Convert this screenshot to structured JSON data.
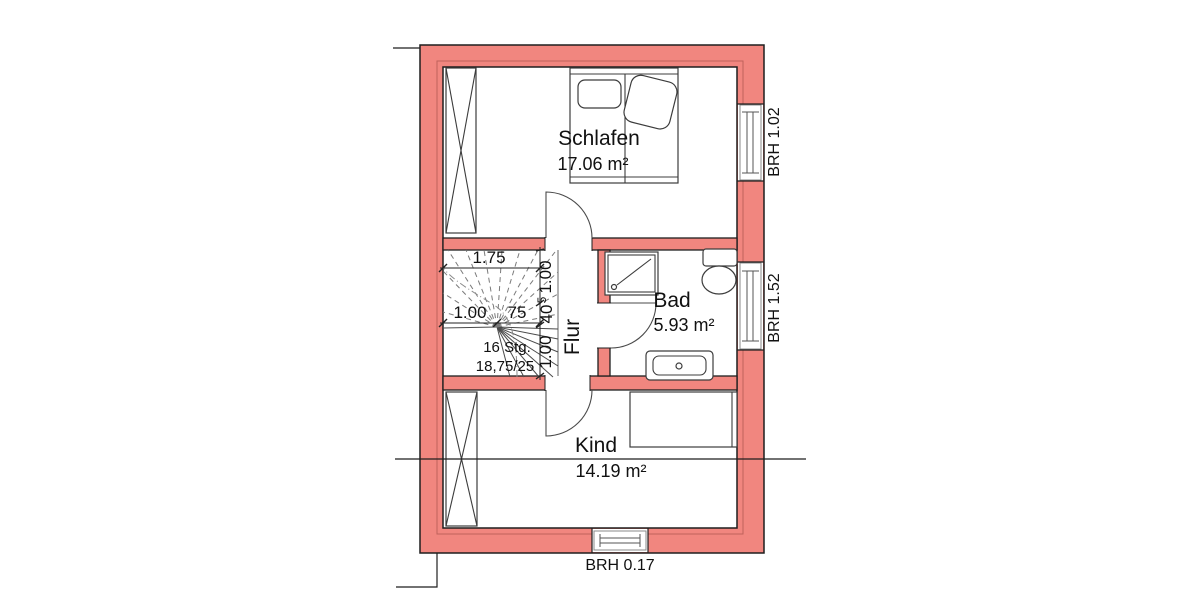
{
  "rooms": {
    "schlafen": {
      "name": "Schlafen",
      "area": "17.06 m²"
    },
    "bad": {
      "name": "Bad",
      "area": "5.93 m²"
    },
    "kind": {
      "name": "Kind",
      "area": "14.19 m²"
    },
    "flur": {
      "name": "Flur"
    }
  },
  "windows": {
    "schlafen_window": {
      "label": "BRH 1.02"
    },
    "bad_window": {
      "label": "BRH 1.52"
    },
    "kind_window": {
      "label": "BRH 0.17"
    }
  },
  "stairs": {
    "steps_label": "16 Stg.",
    "riser_tread_label": "18,75/25"
  },
  "dimensions": {
    "stair_width_total": "1.75",
    "stair_width_left": "1.00",
    "stair_width_right": "75",
    "stair_height_top": "1.00",
    "stair_height_mid": "40",
    "stair_height_mid_sup": "5",
    "stair_height_bottom": "1.00"
  },
  "colors": {
    "wall_fill": "#F1867F",
    "wall_layer_line": "#C0615B",
    "outline": "#1F1F1F",
    "background": "#FFFFFF"
  }
}
